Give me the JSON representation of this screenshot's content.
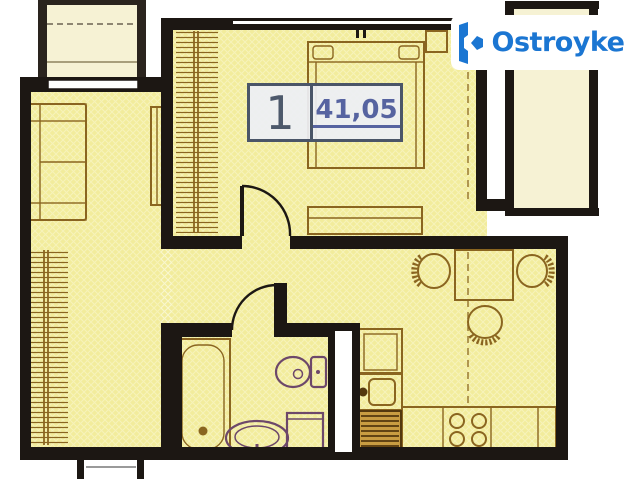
{
  "unit_card": {
    "rooms_count": "1",
    "area_m2": "41,05"
  },
  "logo": {
    "name": "Ostroyke",
    "icon": "ostroyke-building-icon"
  },
  "colors": {
    "brand": "#1b76d2",
    "wall": "#1c1713",
    "plan_fill": "#f2ec9c",
    "balcony_fill": "#f6f2d4",
    "furniture": "#8a6520",
    "sanitary": "#6d486a",
    "hatch": "#8a6520",
    "label_border": "#4a5568",
    "label_number": "#4d596b",
    "label_area": "#5663a0"
  }
}
